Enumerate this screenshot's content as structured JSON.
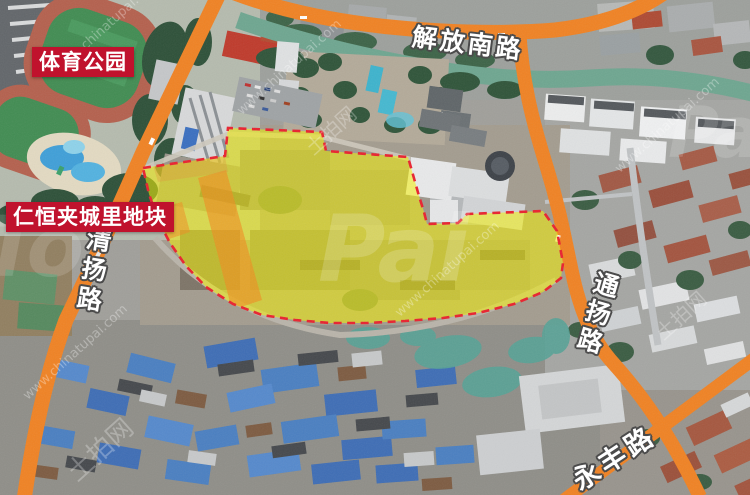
{
  "map": {
    "region_labels": {
      "sports_park": "体育公园",
      "plot_name": "仁恒夹城里地块"
    },
    "roads": {
      "jiefang_south": "解放南路",
      "qingyang": "清扬路",
      "tongyang": "通扬路",
      "yongfeng": "永丰路"
    },
    "plot": {
      "fill_color": "#f6f200",
      "boundary_color": "#e9212e",
      "boundary_style": "dashed"
    },
    "colors": {
      "road_highlight": "#f08223",
      "label_box_bg": "#c0122d",
      "label_text": "#ffffff",
      "canal_water": "#6ea690"
    }
  },
  "watermarks": {
    "site_url": "www.chinatupai.com",
    "site_name": "土拍网",
    "brand_large": "Pai",
    "brand_small": "To"
  }
}
